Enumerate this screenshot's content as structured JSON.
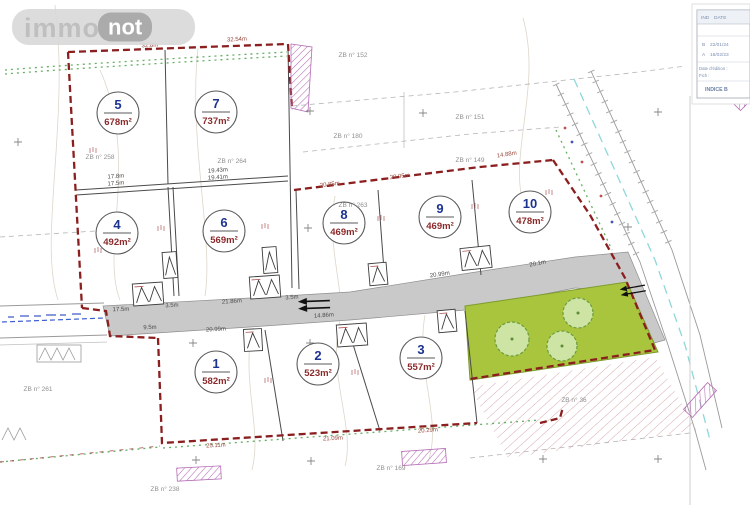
{
  "logo": {
    "immo": "immo",
    "not": "not"
  },
  "plots": [
    {
      "num": "1",
      "area": "582m²"
    },
    {
      "num": "2",
      "area": "523m²"
    },
    {
      "num": "3",
      "area": "557m²"
    },
    {
      "num": "4",
      "area": "492m²"
    },
    {
      "num": "5",
      "area": "678m²"
    },
    {
      "num": "6",
      "area": "569m²"
    },
    {
      "num": "7",
      "area": "737m²"
    },
    {
      "num": "8",
      "area": "469m²"
    },
    {
      "num": "9",
      "area": "469m²"
    },
    {
      "num": "10",
      "area": "478m²"
    }
  ],
  "parcels": [
    "ZB n° 258",
    "ZB n° 264",
    "ZB n° 263",
    "ZB n° 152",
    "ZB n° 180",
    "ZB n° 151",
    "ZB n° 149",
    "ZB n° 261",
    "ZB n° 36",
    "ZB n° 169",
    "ZB n° 238"
  ],
  "measurements": [
    "32.8m",
    "32.54m",
    "17.8m",
    "17.5m",
    "19.43m",
    "19.41m",
    "17.5m",
    "3.5m",
    "21.86m",
    "3.5m",
    "20.85m",
    "20.95m",
    "20.99m",
    "20.1m",
    "9.5m",
    "20.99m",
    "14.86m",
    "25.11m",
    "21.09m",
    "20.29m",
    "14.88m"
  ],
  "titleblock": {
    "col_ind": "IND",
    "col_date": "DATE",
    "rows": [
      {
        "ind": "B",
        "date": "22/01/24"
      },
      {
        "ind": "A",
        "date": "15/02/23"
      }
    ],
    "edition_label": "Date d'édition :",
    "file_label": "Fich :",
    "indice": "INDICE B"
  },
  "colors": {
    "boundary": "#8b1f1f",
    "plot_number": "#1d3390",
    "plot_area": "#8b2a2a",
    "green_area": "#a9c43d",
    "purple_hatch": "#b46ab4",
    "road_fill": "#c9c9c9",
    "centerline_cyan": "#8fd8d8",
    "centerline_blue": "#3b5bd0"
  }
}
